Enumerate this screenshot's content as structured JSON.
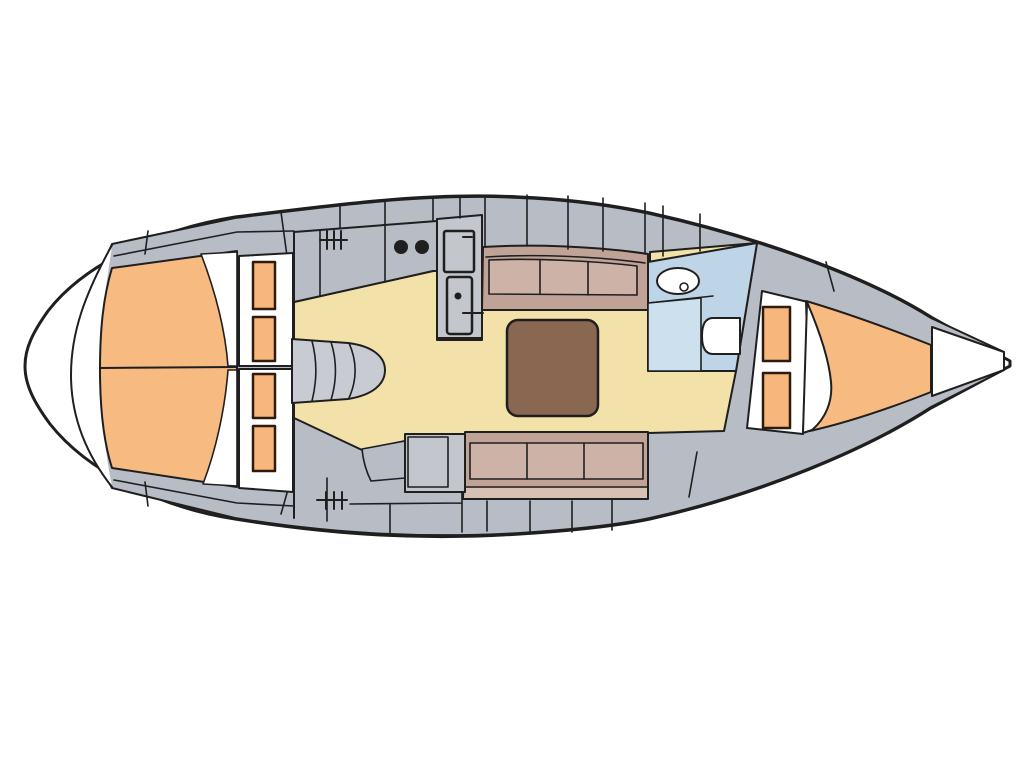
{
  "diagram": {
    "label": "Sailing yacht interior layout floor plan, top view, bow to the right",
    "type": "yacht-floor-plan"
  },
  "colors": {
    "outline": "#1f1f1f",
    "deckGray": "#b7bcc5",
    "panelGray": "#c3c6cd",
    "stepsGray": "#c8cbd2",
    "hullWhite": "#ffffff",
    "floorCream": "#f3e1aa",
    "berthOrange": "#f7ba81",
    "cushionOrange": "#f7b67c",
    "cushionBorder": "#2e1b0d",
    "tableBrown": "#8a6751",
    "setteeFrame": "#c0a296",
    "setteeCushion": "#cdb3a7",
    "setteeFront": "#d7c0b4",
    "headBlue": "#bed4e7",
    "headFloor": "#cde0ee"
  },
  "rooms": {
    "aft_cabin": "aft double berth cabin",
    "saloon": "saloon with table and two settees",
    "galley": "galley with two-burner stove, sink and fridge",
    "nav": "chart table",
    "head": "head with wash basin and toilet",
    "fore_cabin": "fore V-berth cabin"
  },
  "features": {
    "stove_burners": 2,
    "settees": 2,
    "settee_cushions_each": 3,
    "aft_berth_cushions": 4,
    "fore_berth_cushions": 2,
    "deck_hatches": 2
  }
}
